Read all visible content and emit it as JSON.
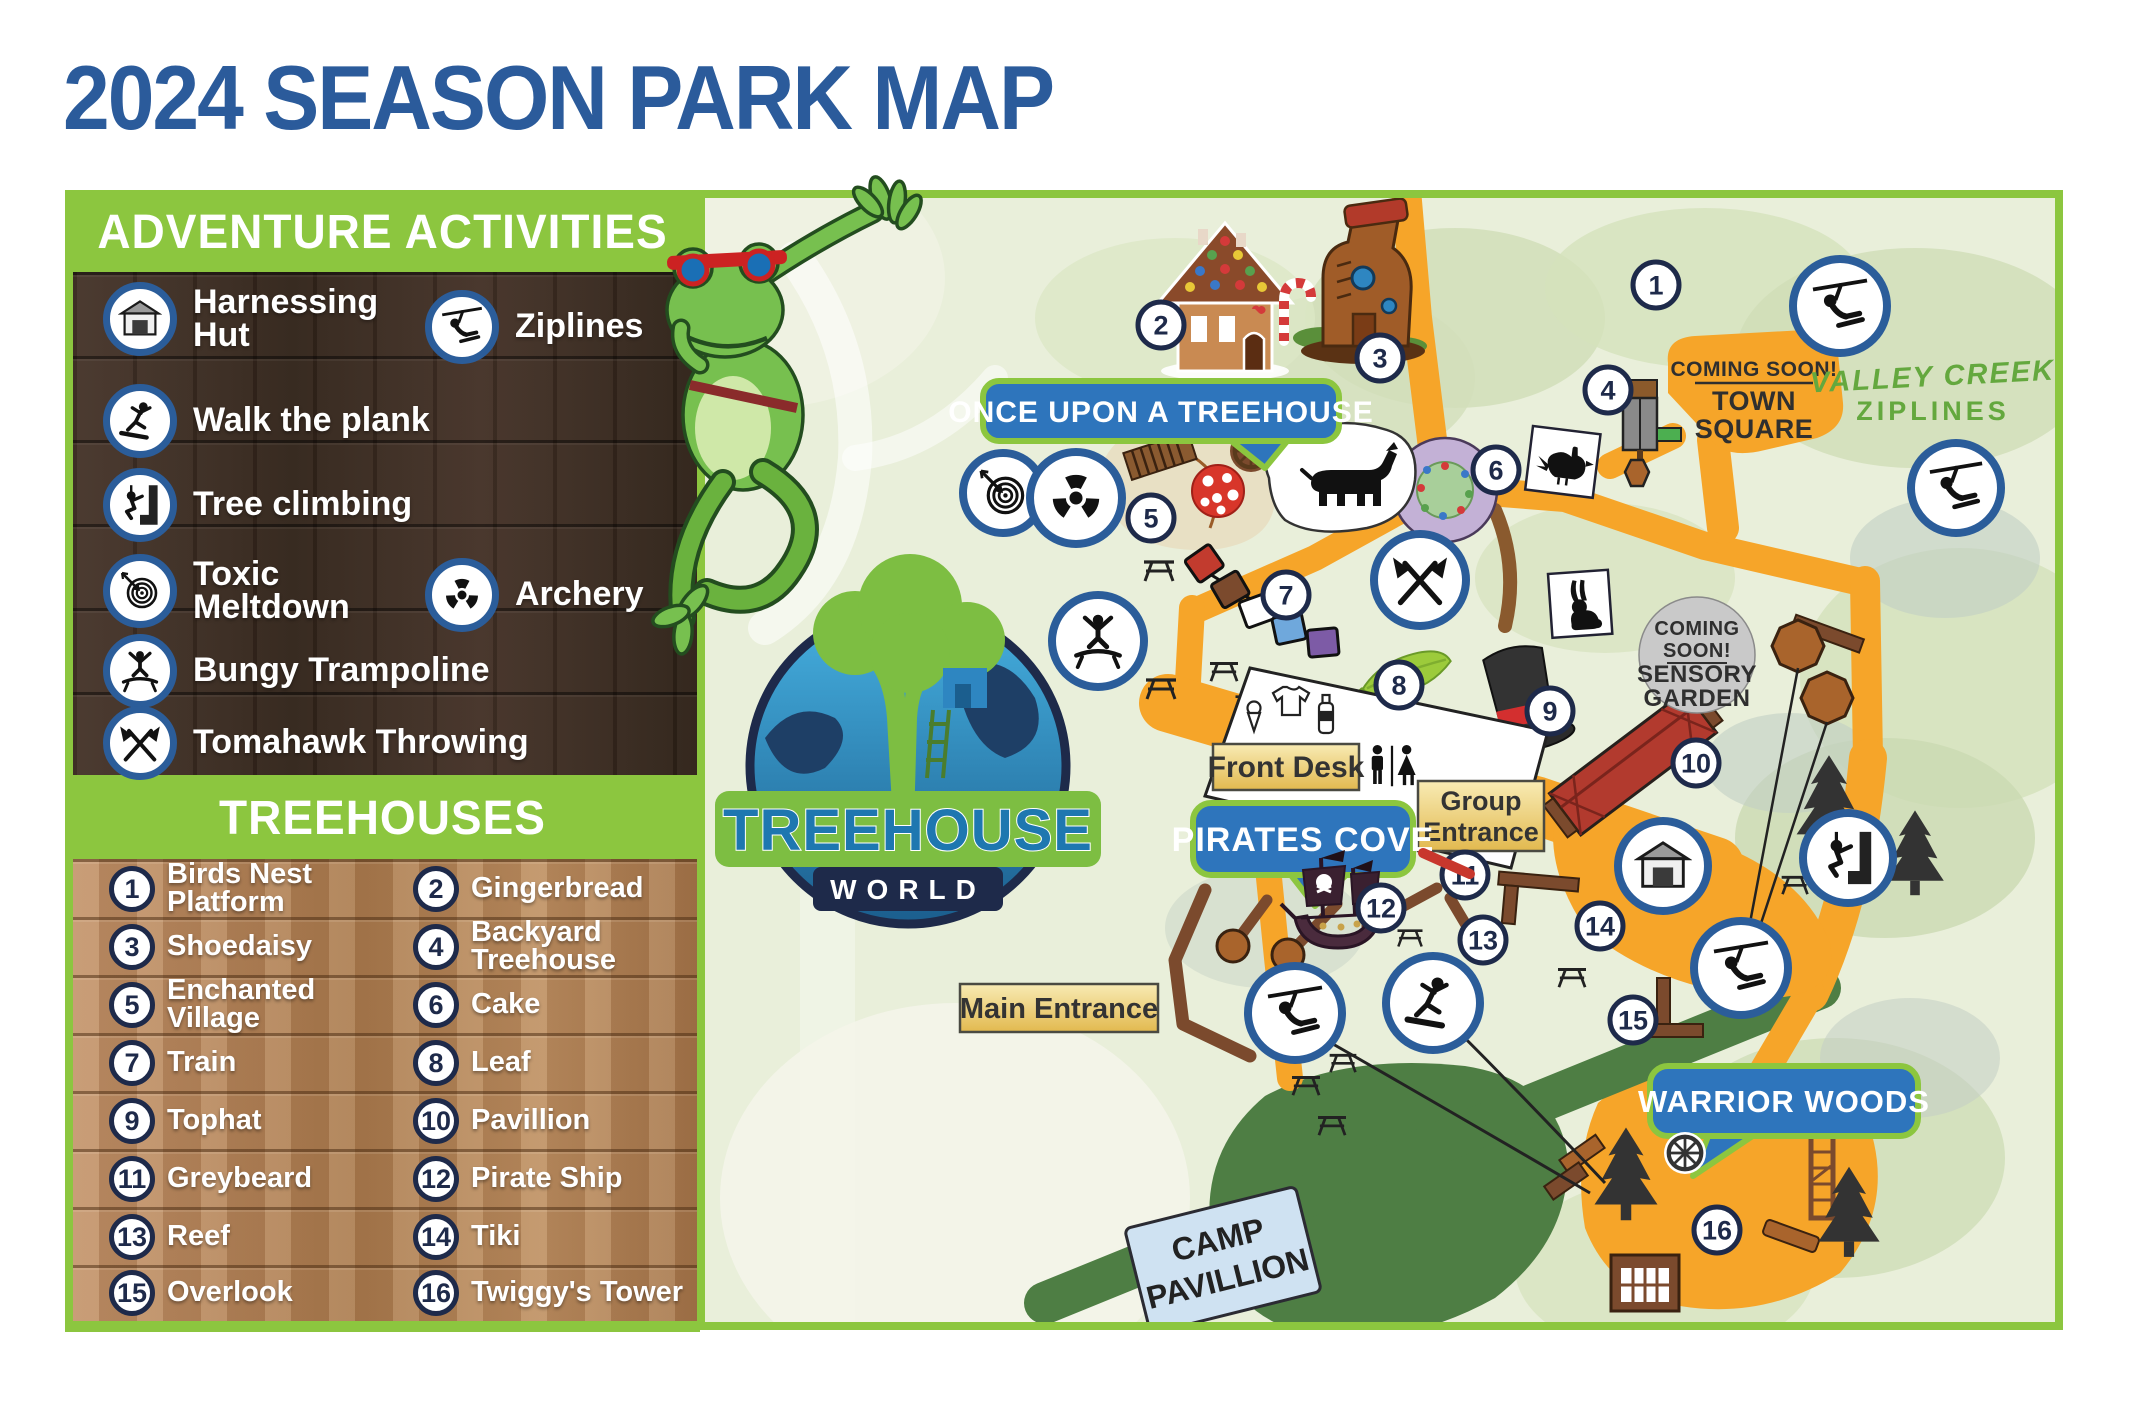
{
  "title": "2024 SEASON PARK MAP",
  "activities": {
    "title": "ADVENTURE ACTIVITIES",
    "items": [
      {
        "label": "Harnessing Hut",
        "icon": "hut-icon"
      },
      {
        "label": "Ziplines",
        "icon": "zipline-icon"
      },
      {
        "label": "Walk the plank",
        "icon": "walk-the-plank-icon"
      },
      {
        "label": "Tree climbing",
        "icon": "tree-climbing-icon"
      },
      {
        "label": "Toxic Meltdown",
        "icon": "target-icon"
      },
      {
        "label": "Archery",
        "icon": "radiation-icon"
      },
      {
        "label": "Bungy Trampoline",
        "icon": "trampoline-icon"
      },
      {
        "label": "Tomahawk Throwing",
        "icon": "tomahawk-icon"
      }
    ]
  },
  "treehouses": {
    "title": "TREEHOUSES",
    "items": [
      {
        "num": "1",
        "label": "Birds Nest Platform"
      },
      {
        "num": "2",
        "label": "Gingerbread"
      },
      {
        "num": "3",
        "label": "Shoedaisy"
      },
      {
        "num": "4",
        "label": "Backyard Treehouse"
      },
      {
        "num": "5",
        "label": "Enchanted Village"
      },
      {
        "num": "6",
        "label": "Cake"
      },
      {
        "num": "7",
        "label": "Train"
      },
      {
        "num": "8",
        "label": "Leaf"
      },
      {
        "num": "9",
        "label": "Tophat"
      },
      {
        "num": "10",
        "label": "Pavillion"
      },
      {
        "num": "11",
        "label": "Greybeard"
      },
      {
        "num": "12",
        "label": "Pirate Ship"
      },
      {
        "num": "13",
        "label": "Reef"
      },
      {
        "num": "14",
        "label": "Tiki"
      },
      {
        "num": "15",
        "label": "Overlook"
      },
      {
        "num": "16",
        "label": "Twiggy's Tower"
      }
    ]
  },
  "logo": {
    "name": "TREEHOUSE",
    "world": "WORLD"
  },
  "map": {
    "marker_labels": [
      "1",
      "2",
      "3",
      "4",
      "5",
      "6",
      "7",
      "8",
      "9",
      "10",
      "11",
      "12",
      "13",
      "14",
      "15",
      "16"
    ],
    "bubbles": {
      "once_upon": "ONCE UPON A TREEHOUSE",
      "pirates_cove": "PIRATES COVE",
      "warrior_woods": "WARRIOR WOODS"
    },
    "labels": {
      "front_desk": "Front Desk",
      "group_entrance_line1": "Group",
      "group_entrance_line2": "Entrance",
      "main_entrance": "Main Entrance",
      "camp_line1": "CAMP",
      "camp_line2": "PAVILLION"
    },
    "coming_soon_town": {
      "line1": "COMING SOON!",
      "line2": "TOWN",
      "line3": "SQUARE"
    },
    "coming_soon_sensory": {
      "line1": "COMING",
      "line2": "SOON!",
      "line3": "SENSORY",
      "line4": "GARDEN"
    },
    "valley_creek": {
      "line1": "VALLEY CREEK",
      "line2": "ZIPLINES"
    }
  },
  "colors": {
    "accent_green": "#8CC63F",
    "title_blue": "#2B5B9B",
    "path_orange": "#F6A529",
    "bubble_blue": "#2E75BC",
    "marker_navy": "#1E2A4A",
    "road_green": "#4E7E44"
  }
}
